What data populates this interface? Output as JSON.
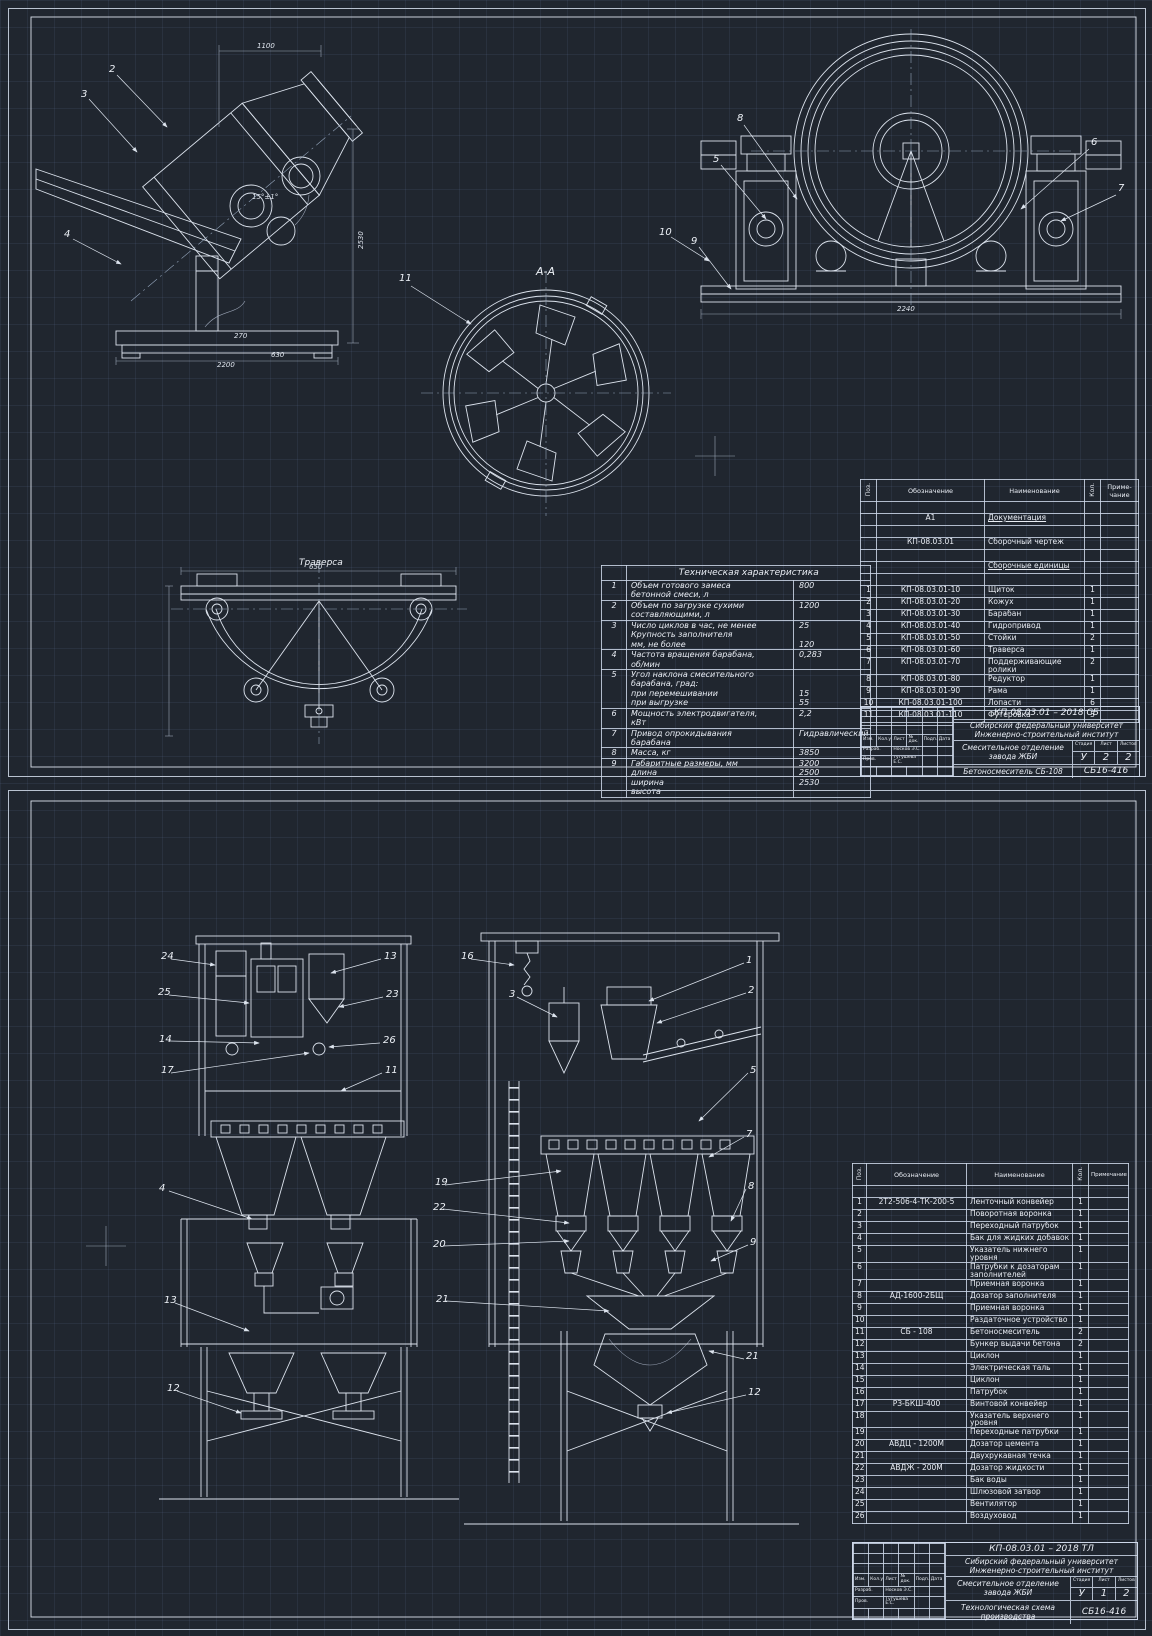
{
  "palette": {
    "background": "#20262f",
    "line": "#dce3ed",
    "grid": "#32405c",
    "text": "#e9edf4"
  },
  "sheet1": {
    "view_labels": {
      "section": "А-А",
      "traverse": "Траверса"
    },
    "callouts": {
      "side": [
        "2",
        "3",
        "4"
      ],
      "front": [
        "8",
        "5",
        "9",
        "10",
        "6",
        "7"
      ],
      "section": "11"
    },
    "dims": {
      "side_top": "1100",
      "side_height": "2530",
      "side_angle": "15°±1°",
      "side_b1": "270",
      "side_b2": "630",
      "side_b3": "2200",
      "front_width": "2240",
      "trav_width": "650"
    },
    "tech": {
      "title": "Техническая характеристика",
      "rows": [
        {
          "n": "1",
          "name": "Объем готового замеса\nбетонной смеси, л",
          "value": "800"
        },
        {
          "n": "2",
          "name": "Объем по загрузке сухими\nсоставляющими, л",
          "value": "1200"
        },
        {
          "n": "3",
          "name": "Число циклов в час, не менее\nКрупность заполнителя\nмм, не более",
          "value": "25\n\n120"
        },
        {
          "n": "4",
          "name": "Частота вращения барабана,\nоб/мин",
          "value": "0,283"
        },
        {
          "n": "5",
          "name": "Угол наклона смесительного\nбарабана, град:\nпри перемешивании\nпри выгрузке",
          "value": "\n\n15\n55"
        },
        {
          "n": "6",
          "name": "Мощность электродвигателя,\nкВт",
          "value": "2,2"
        },
        {
          "n": "7",
          "name": "Привод опрокидывания\nбарабана",
          "value": "Гидравлический"
        },
        {
          "n": "8",
          "name": "Масса, кг",
          "value": "3850"
        },
        {
          "n": "9",
          "name": "Габаритные размеры, мм\nдлина\nширина\nвысота",
          "value": "3200\n2500\n2530"
        }
      ]
    },
    "spec": {
      "headers": {
        "pos": "Поз.",
        "mark": "Обозначение",
        "name": "Наименование",
        "qty": "Кол.",
        "note": "Приме-\nчание"
      },
      "rows": [
        {
          "pos": "",
          "mark": "",
          "name": "",
          "qty": "",
          "note": ""
        },
        {
          "pos": "",
          "mark": "А1",
          "name": "Документация",
          "qty": "",
          "note": "",
          "cls": "u"
        },
        {
          "pos": "",
          "mark": "",
          "name": "",
          "qty": "",
          "note": ""
        },
        {
          "pos": "",
          "mark": "КП-08.03.01",
          "name": "Сборочный чертеж",
          "qty": "",
          "note": ""
        },
        {
          "pos": "",
          "mark": "",
          "name": "",
          "qty": "",
          "note": ""
        },
        {
          "pos": "",
          "mark": "",
          "name": "Сборочные единицы",
          "qty": "",
          "note": "",
          "cls": "u"
        },
        {
          "pos": "",
          "mark": "",
          "name": "",
          "qty": "",
          "note": ""
        },
        {
          "pos": "1",
          "mark": "КП-08.03.01-10",
          "name": "Щиток",
          "qty": "1",
          "note": ""
        },
        {
          "pos": "2",
          "mark": "КП-08.03.01-20",
          "name": "Кожух",
          "qty": "1",
          "note": ""
        },
        {
          "pos": "3",
          "mark": "КП-08.03.01-30",
          "name": "Барабан",
          "qty": "1",
          "note": ""
        },
        {
          "pos": "4",
          "mark": "КП-08.03.01-40",
          "name": "Гидропривод",
          "qty": "1",
          "note": ""
        },
        {
          "pos": "5",
          "mark": "КП-08.03.01-50",
          "name": "Стойки",
          "qty": "2",
          "note": ""
        },
        {
          "pos": "6",
          "mark": "КП-08.03.01-60",
          "name": "Траверса",
          "qty": "1",
          "note": ""
        },
        {
          "pos": "7",
          "mark": "КП-08.03.01-70",
          "name": "Поддерживающие ролики",
          "qty": "2",
          "note": ""
        },
        {
          "pos": "8",
          "mark": "КП-08.03.01-80",
          "name": "Редуктор",
          "qty": "1",
          "note": ""
        },
        {
          "pos": "9",
          "mark": "КП-08.03.01-90",
          "name": "Рама",
          "qty": "1",
          "note": ""
        },
        {
          "pos": "10",
          "mark": "КП-08.03.01-100",
          "name": "Лопасти",
          "qty": "6",
          "note": ""
        },
        {
          "pos": "11",
          "mark": "КП-08.03.01-110",
          "name": "Футеровка",
          "qty": "5",
          "note": ""
        }
      ]
    },
    "title_block": {
      "doc": "КП-08.03.01 – 2018 СБ",
      "org": "Сибирский федеральный университет\nИнженерно-строительный институт",
      "subject": "Смесительное отделение\nзавода ЖБИ",
      "product": "Бетоносмеситель СБ-108",
      "code": "СБ16-416",
      "stage_h": "Стадия",
      "sheet_h": "Лист",
      "sheets_h": "Листов",
      "stage": "У",
      "sheet_no": "2",
      "sheets": "2",
      "sig": {
        "header": [
          "Изм.",
          "Кол.уч.",
          "Лист",
          "№ док.",
          "Подп.",
          "Дата"
        ],
        "rows": [
          {
            "role": "Разраб.",
            "name": "Носков Э.С."
          },
          {
            "role": "Пров.",
            "name": "Тугушева Е.С."
          }
        ]
      }
    }
  },
  "sheet2": {
    "callouts": {
      "left_left": [
        "24",
        "25",
        "14",
        "17",
        "4",
        "13",
        "12"
      ],
      "left_right": [
        "13",
        "23",
        "26",
        "11"
      ],
      "right_left": [
        "16",
        "3",
        "19",
        "22",
        "20",
        "21"
      ],
      "right_right": [
        "1",
        "2",
        "5",
        "7",
        "8",
        "9",
        "21",
        "12"
      ]
    },
    "spec": {
      "headers": {
        "pos": "Поз.",
        "mark": "Обозначение",
        "name": "Наименование",
        "qty": "Кол.",
        "note": "Примечание"
      },
      "rows": [
        {
          "pos": "",
          "mark": "",
          "name": "",
          "qty": "",
          "note": ""
        },
        {
          "pos": "1",
          "mark": "2Т2-506-4-ТК-200-5",
          "name": "Ленточный конвейер",
          "qty": "1",
          "note": ""
        },
        {
          "pos": "2",
          "mark": "",
          "name": "Поворотная воронка",
          "qty": "1",
          "note": ""
        },
        {
          "pos": "3",
          "mark": "",
          "name": "Переходный патрубок",
          "qty": "1",
          "note": ""
        },
        {
          "pos": "4",
          "mark": "",
          "name": "Бак для жидких добавок",
          "qty": "1",
          "note": ""
        },
        {
          "pos": "5",
          "mark": "",
          "name": "Указатель нижнего уровня",
          "qty": "1",
          "note": ""
        },
        {
          "pos": "6",
          "mark": "",
          "name": "Патрубки к дозаторам заполнителей",
          "qty": "1",
          "note": ""
        },
        {
          "pos": "7",
          "mark": "",
          "name": "Приемная воронка",
          "qty": "1",
          "note": ""
        },
        {
          "pos": "8",
          "mark": "АД-1600-2БЩ",
          "name": "Дозатор заполнителя",
          "qty": "1",
          "note": ""
        },
        {
          "pos": "9",
          "mark": "",
          "name": "Приемная воронка",
          "qty": "1",
          "note": ""
        },
        {
          "pos": "10",
          "mark": "",
          "name": "Раздаточное устройство",
          "qty": "1",
          "note": ""
        },
        {
          "pos": "11",
          "mark": "СБ - 108",
          "name": "Бетоносмеситель",
          "qty": "2",
          "note": ""
        },
        {
          "pos": "12",
          "mark": "",
          "name": "Бункер выдачи бетона",
          "qty": "2",
          "note": ""
        },
        {
          "pos": "13",
          "mark": "",
          "name": "Циклон",
          "qty": "1",
          "note": ""
        },
        {
          "pos": "14",
          "mark": "",
          "name": "Электрическая таль",
          "qty": "1",
          "note": ""
        },
        {
          "pos": "15",
          "mark": "",
          "name": "Циклон",
          "qty": "1",
          "note": ""
        },
        {
          "pos": "16",
          "mark": "",
          "name": "Патрубок",
          "qty": "1",
          "note": ""
        },
        {
          "pos": "17",
          "mark": "РЗ-БКШ-400",
          "name": "Винтовой конвейер",
          "qty": "1",
          "note": ""
        },
        {
          "pos": "18",
          "mark": "",
          "name": "Указатель верхнего уровня",
          "qty": "1",
          "note": ""
        },
        {
          "pos": "19",
          "mark": "",
          "name": "Переходные патрубки",
          "qty": "1",
          "note": ""
        },
        {
          "pos": "20",
          "mark": "АВДЦ - 1200М",
          "name": "Дозатор цемента",
          "qty": "1",
          "note": ""
        },
        {
          "pos": "21",
          "mark": "",
          "name": "Двухрукавная течка",
          "qty": "1",
          "note": ""
        },
        {
          "pos": "22",
          "mark": "АВДЖ - 200М",
          "name": "Дозатор жидкости",
          "qty": "1",
          "note": ""
        },
        {
          "pos": "23",
          "mark": "",
          "name": "Бак воды",
          "qty": "1",
          "note": ""
        },
        {
          "pos": "24",
          "mark": "",
          "name": "Шлюзовой затвор",
          "qty": "1",
          "note": ""
        },
        {
          "pos": "25",
          "mark": "",
          "name": "Вентилятор",
          "qty": "1",
          "note": ""
        },
        {
          "pos": "26",
          "mark": "",
          "name": "Воздуховод",
          "qty": "1",
          "note": ""
        }
      ]
    },
    "title_block": {
      "doc": "КП-08.03.01 – 2018 ТЛ",
      "org": "Сибирский федеральный университет\nИнженерно-строительный институт",
      "subject": "Смесительное отделение\nзавода ЖБИ",
      "product": "Технологическая схема\nпроизводства",
      "code": "СБ16-416",
      "stage_h": "Стадия",
      "sheet_h": "Лист",
      "sheets_h": "Листов",
      "stage": "У",
      "sheet_no": "1",
      "sheets": "2",
      "sig": {
        "header": [
          "Изм.",
          "Кол.уч.",
          "Лист",
          "№ док.",
          "Подп.",
          "Дата"
        ],
        "rows": [
          {
            "role": "Разраб.",
            "name": "Носков Э.С."
          },
          {
            "role": "Пров.",
            "name": "Тугушева Е.С."
          }
        ]
      }
    }
  }
}
